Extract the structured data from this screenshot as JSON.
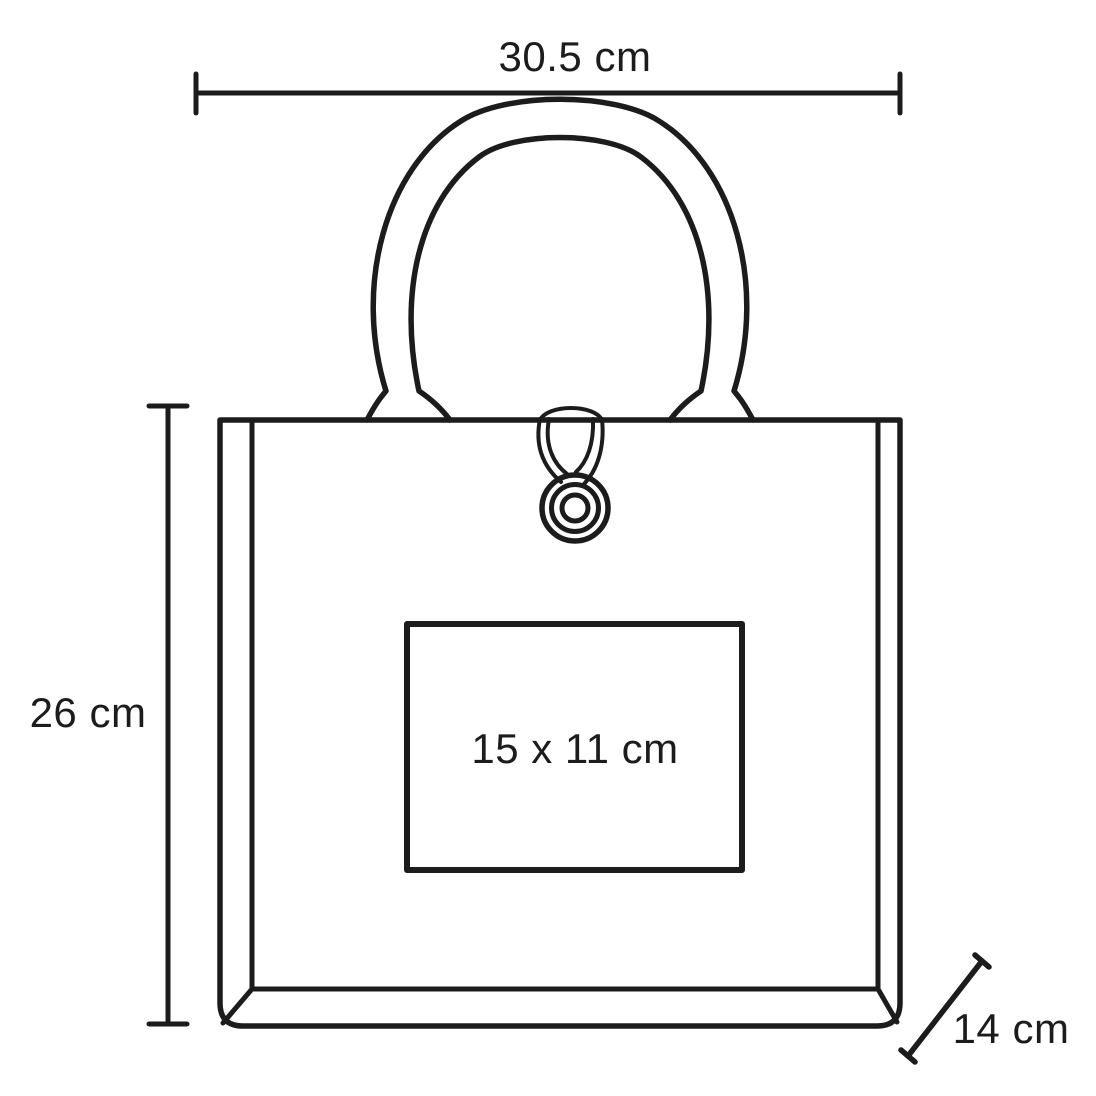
{
  "diagram": {
    "title": "tote bag dimension drawing",
    "background_color": "#ffffff",
    "line_color": "#1c1c1c",
    "labels": {
      "width": "30.5 cm",
      "height": "26 cm",
      "print_area": "15 x 11 cm",
      "depth": "14 cm"
    }
  }
}
